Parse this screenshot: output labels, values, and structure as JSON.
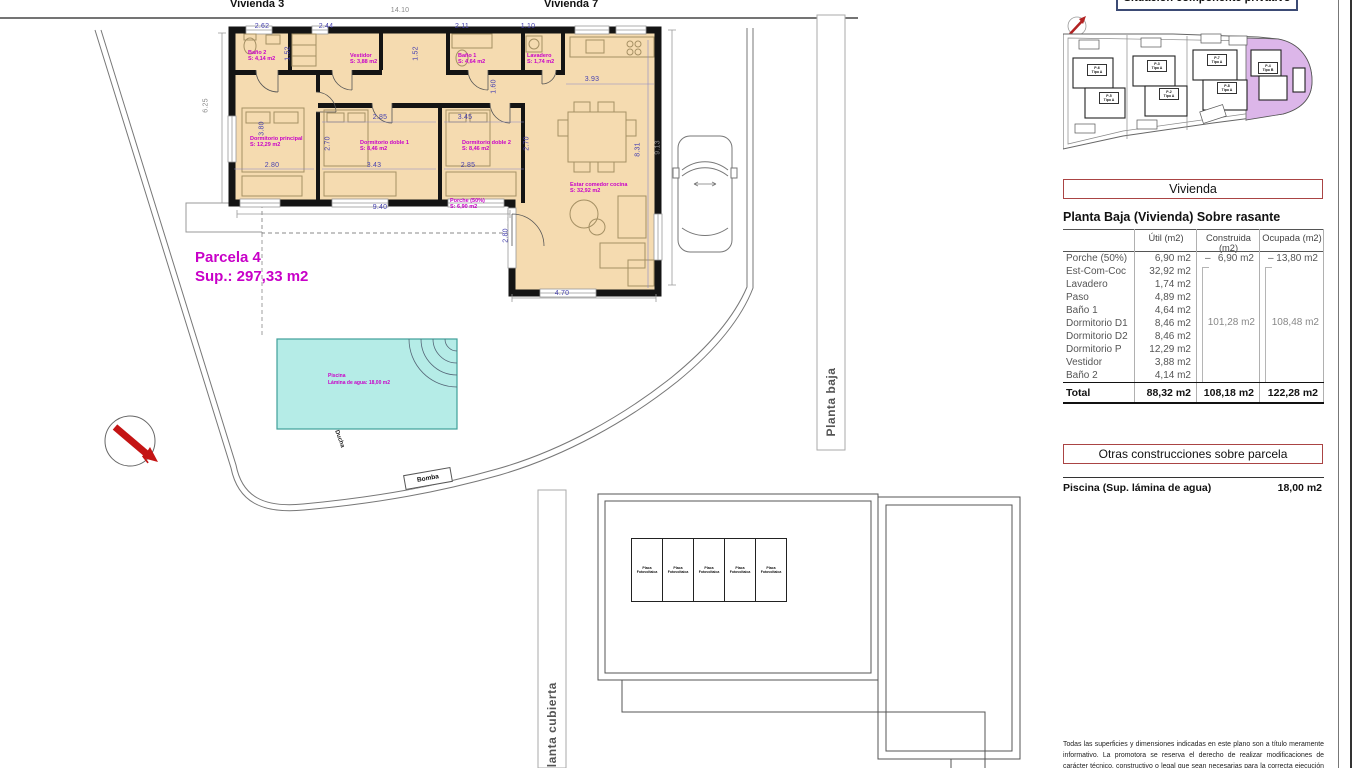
{
  "colors": {
    "floor": "#f5dbb0",
    "wall": "#141414",
    "magenta": "#c800c8",
    "dim_blue": "#4843b0",
    "dim_gray": "#8a8a8a",
    "pool_fill": "#b5ece7",
    "pool_stroke": "#3f9f9a",
    "red_accent": "#c41414",
    "box_red_border": "#aa4444",
    "title_border_navy": "#3b4a74",
    "highlight_plot_purple": "#dcb6e9"
  },
  "top": {
    "vivienda_left": "Vivienda 3",
    "vivienda_right": "Vivienda 7"
  },
  "plan": {
    "parcela_title": "Parcela 4",
    "parcela_sup": "Sup.: 297,33 m2",
    "pool_label": "Piscina",
    "pool_sub": "Lámina de agua: 18,00 m2",
    "north_letter": "N",
    "ducha": "Ducha",
    "bomba": "Bomba",
    "planta_baja": "Planta baja",
    "planta_cubierta": "Planta cubierta",
    "solar_panel": {
      "line1": "Placa",
      "line2": "Fotovoltaica",
      "count": 5
    },
    "rooms": [
      {
        "name": "Baño 2",
        "area": "S: 4,14 m2",
        "x": 248,
        "y": 50
      },
      {
        "name": "Vestidor",
        "area": "S: 3,88 m2",
        "x": 350,
        "y": 53
      },
      {
        "name": "Baño 1",
        "area": "S: 4,64 m2",
        "x": 458,
        "y": 53
      },
      {
        "name": "Lavadero",
        "area": "S: 1,74 m2",
        "x": 527,
        "y": 53
      },
      {
        "name": "Dormitorio principal",
        "area": "S: 12,29 m2",
        "x": 250,
        "y": 136
      },
      {
        "name": "Dormitorio doble 1",
        "area": "S: 8,46 m2",
        "x": 360,
        "y": 140
      },
      {
        "name": "Dormitorio doble 2",
        "area": "S: 8,46 m2",
        "x": 462,
        "y": 140
      },
      {
        "name": "Estar comedor cocina",
        "area": "S: 32,92 m2",
        "x": 570,
        "y": 182
      },
      {
        "name": "Porche (50%)",
        "area": "S: 6,90 m2",
        "x": 450,
        "y": 198
      }
    ],
    "dims": [
      {
        "t": "14.10",
        "x": 400,
        "y": 7,
        "c": "gray"
      },
      {
        "t": "2.62",
        "x": 262,
        "y": 23,
        "c": "blue"
      },
      {
        "t": "2.44",
        "x": 326,
        "y": 23,
        "c": "blue"
      },
      {
        "t": "2.11",
        "x": 462,
        "y": 23,
        "c": "blue"
      },
      {
        "t": "1.10",
        "x": 528,
        "y": 23,
        "c": "blue"
      },
      {
        "t": "1.52",
        "x": 288,
        "y": 50,
        "r": -90,
        "c": "blue"
      },
      {
        "t": "1.52",
        "x": 416,
        "y": 50,
        "r": -90,
        "c": "blue"
      },
      {
        "t": "3.93",
        "x": 592,
        "y": 76,
        "c": "blue"
      },
      {
        "t": "1.60",
        "x": 494,
        "y": 83,
        "r": -90,
        "c": "blue"
      },
      {
        "t": "2.85",
        "x": 380,
        "y": 114,
        "c": "blue"
      },
      {
        "t": "3.45",
        "x": 465,
        "y": 114,
        "c": "blue"
      },
      {
        "t": "3.80",
        "x": 262,
        "y": 125,
        "r": -90,
        "c": "blue"
      },
      {
        "t": "2.70",
        "x": 328,
        "y": 140,
        "r": -90,
        "c": "blue"
      },
      {
        "t": "2.70",
        "x": 527,
        "y": 140,
        "r": -90,
        "c": "blue"
      },
      {
        "t": "2.80",
        "x": 272,
        "y": 162,
        "c": "blue"
      },
      {
        "t": "3.43",
        "x": 374,
        "y": 162,
        "c": "blue"
      },
      {
        "t": "2.85",
        "x": 468,
        "y": 162,
        "c": "blue"
      },
      {
        "t": "9.40",
        "x": 380,
        "y": 204,
        "c": "blue"
      },
      {
        "t": "2.80",
        "x": 506,
        "y": 232,
        "r": -90,
        "c": "blue"
      },
      {
        "t": "4.70",
        "x": 562,
        "y": 290,
        "c": "blue"
      },
      {
        "t": "8.31",
        "x": 638,
        "y": 146,
        "r": -90,
        "c": "blue"
      },
      {
        "t": "6.25",
        "x": 206,
        "y": 102,
        "r": -90,
        "c": "gray"
      },
      {
        "t": "9.13",
        "x": 658,
        "y": 144,
        "r": -90,
        "c": "gray"
      }
    ]
  },
  "panel": {
    "title": "Situación componente privativo",
    "plots": [
      {
        "id": "P-6",
        "tipo": "Tipo A",
        "x": 1087,
        "y": 64
      },
      {
        "id": "P-5",
        "tipo": "Tipo A",
        "x": 1099,
        "y": 92
      },
      {
        "id": "P-3",
        "tipo": "Tipo A",
        "x": 1147,
        "y": 60
      },
      {
        "id": "P-2",
        "tipo": "Tipo A",
        "x": 1159,
        "y": 88
      },
      {
        "id": "P-7",
        "tipo": "Tipo A",
        "x": 1207,
        "y": 54
      },
      {
        "id": "P-8",
        "tipo": "Tipo A",
        "x": 1217,
        "y": 82
      },
      {
        "id": "P-4",
        "tipo": "Tipo B",
        "x": 1258,
        "y": 62
      }
    ],
    "vivienda_header": "Vivienda",
    "table_title": "Planta Baja (Vivienda) Sobre rasante",
    "table": {
      "columns": {
        "util": "Útil (m2)",
        "construida": "Construida (m2)",
        "ocupada": "Ocupada (m2)"
      },
      "dash": "–",
      "rows": [
        {
          "label": "Porche (50%)",
          "util": "6,90 m2",
          "construida": "6,90 m2",
          "ocupada": "13,80 m2"
        },
        {
          "label": "Est-Com-Coc",
          "util": "32,92 m2"
        },
        {
          "label": "Lavadero",
          "util": "1,74 m2"
        },
        {
          "label": "Paso",
          "util": "4,89 m2"
        },
        {
          "label": "Baño 1",
          "util": "4,64 m2"
        },
        {
          "label": "Dormitorio D1",
          "util": "8,46 m2"
        },
        {
          "label": "Dormitorio D2",
          "util": "8,46 m2"
        },
        {
          "label": "Dormitorio P",
          "util": "12,29 m2"
        },
        {
          "label": "Vestidor",
          "util": "3,88 m2"
        },
        {
          "label": "Baño 2",
          "util": "4,14 m2"
        }
      ],
      "construida_group": "101,28 m2",
      "ocupada_group": "108,48 m2",
      "total": {
        "label": "Total",
        "util": "88,32 m2",
        "construida": "108,18 m2",
        "ocupada": "122,28 m2"
      }
    },
    "otras_header": "Otras construcciones sobre parcela",
    "piscina_label": "Piscina (Sup. lámina de agua)",
    "piscina_value": "18,00 m2",
    "disclaimer": "Todas las superficies y dimensiones indicadas en este plano son a título meramente informativo. La promotora se reserva el derecho de realizar modificaciones de carácter técnico, constructivo o legal que sean necesarias para la correcta ejecución del proyecto."
  }
}
